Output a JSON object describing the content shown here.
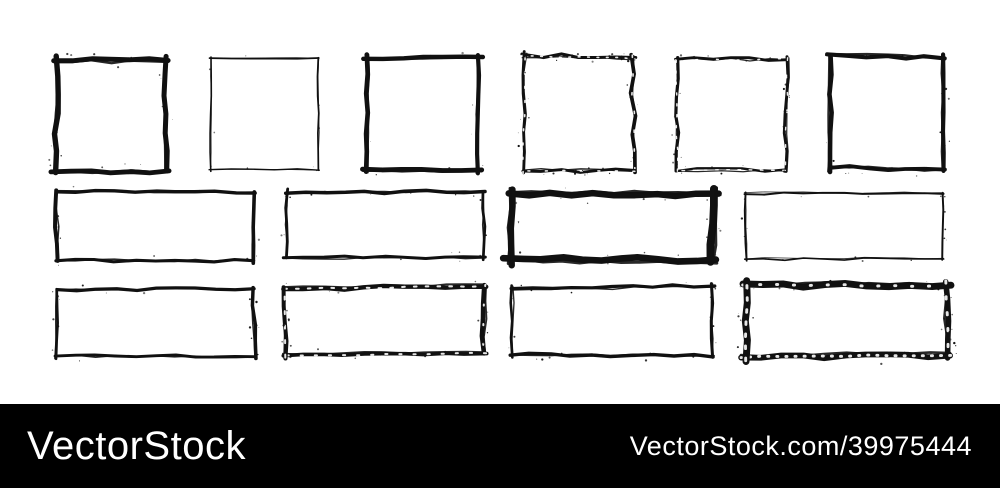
{
  "canvas": {
    "width": 1000,
    "height": 488,
    "background": "#ffffff",
    "ink": "#111111",
    "frames_area_height": 404
  },
  "watermark": {
    "left_text": "VectorStock",
    "right_text": "VectorStock.com/39975444",
    "bar_color": "#000000",
    "text_color": "#ffffff"
  },
  "frames": [
    {
      "name": "square-1",
      "shape": "square",
      "x": 57,
      "y": 60,
      "w": 108,
      "h": 111,
      "stroke": 5.0,
      "jitter": 2.0,
      "grunge": 0.5,
      "seed": 11
    },
    {
      "name": "square-2",
      "shape": "square",
      "x": 211,
      "y": 59,
      "w": 108,
      "h": 110,
      "stroke": 1.6,
      "jitter": 1.0,
      "grunge": 0.2,
      "seed": 22
    },
    {
      "name": "square-3",
      "shape": "square",
      "x": 367,
      "y": 58,
      "w": 111,
      "h": 111,
      "stroke": 4.2,
      "jitter": 1.0,
      "grunge": 0.2,
      "seed": 33
    },
    {
      "name": "square-4",
      "shape": "square",
      "x": 523,
      "y": 57,
      "w": 111,
      "h": 114,
      "stroke": 3.2,
      "jitter": 2.4,
      "grunge": 0.9,
      "seed": 44
    },
    {
      "name": "square-5",
      "shape": "square",
      "x": 677,
      "y": 58,
      "w": 110,
      "h": 113,
      "stroke": 2.8,
      "jitter": 2.0,
      "grunge": 0.7,
      "seed": 55
    },
    {
      "name": "square-6",
      "shape": "square",
      "x": 832,
      "y": 57,
      "w": 112,
      "h": 112,
      "stroke": 4.5,
      "jitter": 1.8,
      "grunge": 0.4,
      "seed": 66
    },
    {
      "name": "rect-mid-1",
      "shape": "rect",
      "x": 56,
      "y": 193,
      "w": 198,
      "h": 67,
      "stroke": 3.5,
      "jitter": 1.5,
      "grunge": 0.4,
      "seed": 77
    },
    {
      "name": "rect-mid-2",
      "shape": "rect",
      "x": 286,
      "y": 192,
      "w": 198,
      "h": 66,
      "stroke": 3.0,
      "jitter": 1.5,
      "grunge": 0.5,
      "seed": 88
    },
    {
      "name": "rect-mid-3",
      "shape": "rect",
      "x": 513,
      "y": 193,
      "w": 200,
      "h": 66,
      "stroke": 6.8,
      "jitter": 2.2,
      "grunge": 0.6,
      "seed": 99
    },
    {
      "name": "rect-mid-4",
      "shape": "rect",
      "x": 746,
      "y": 193,
      "w": 197,
      "h": 65,
      "stroke": 1.8,
      "jitter": 1.3,
      "grunge": 0.5,
      "seed": 101
    },
    {
      "name": "rect-bot-1",
      "shape": "rect",
      "x": 56,
      "y": 289,
      "w": 198,
      "h": 67,
      "stroke": 3.0,
      "jitter": 1.5,
      "grunge": 0.4,
      "seed": 111
    },
    {
      "name": "rect-bot-2",
      "shape": "rect",
      "x": 286,
      "y": 287,
      "w": 198,
      "h": 68,
      "stroke": 4.0,
      "jitter": 1.8,
      "grunge": 0.7,
      "seed": 121
    },
    {
      "name": "rect-bot-3",
      "shape": "rect",
      "x": 513,
      "y": 287,
      "w": 200,
      "h": 68,
      "stroke": 3.0,
      "jitter": 1.5,
      "grunge": 0.5,
      "seed": 131
    },
    {
      "name": "rect-bot-4",
      "shape": "rect",
      "x": 746,
      "y": 286,
      "w": 201,
      "h": 70,
      "stroke": 5.8,
      "jitter": 2.0,
      "grunge": 0.7,
      "seed": 141
    }
  ]
}
